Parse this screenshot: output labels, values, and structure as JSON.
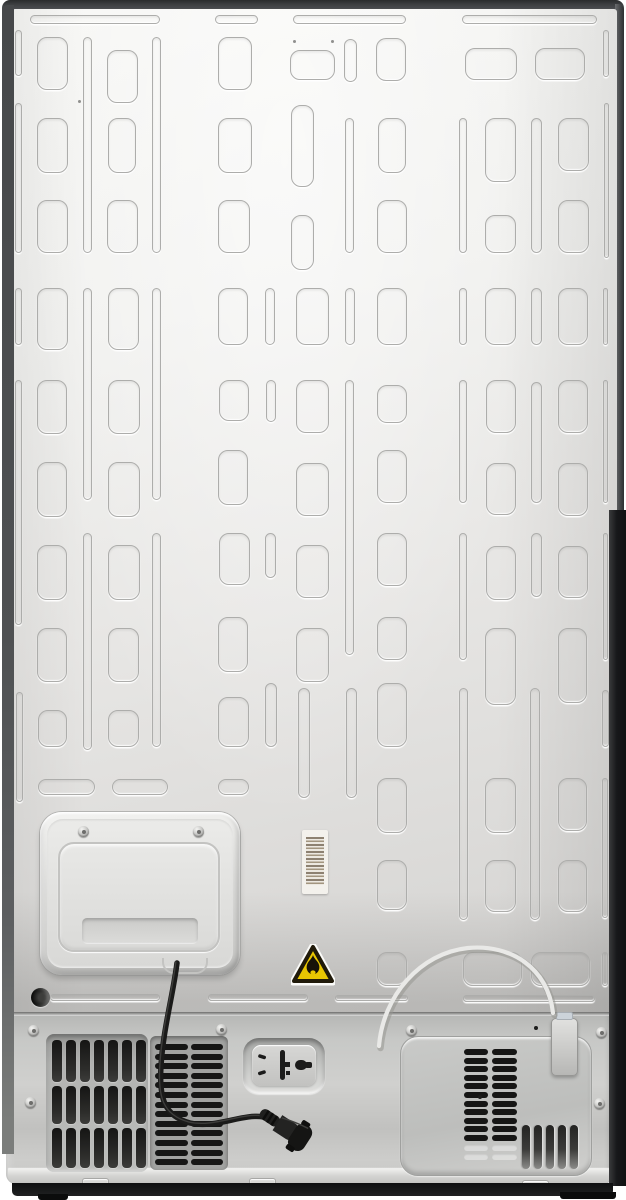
{
  "scene": {
    "label": "refrigerator-rear-view",
    "palette": {
      "panel_light": "#f7f7f5",
      "panel_dark": "#d3d2d0",
      "frame_dark": "#4f5153",
      "compartment_gray": "#c7c8c6",
      "slot_dark": "#1c1c1b",
      "warning_yellow": "#e8c602",
      "warning_border": "#201a0a",
      "barcode_bar": "#8d8171",
      "cord_black": "#1a1a19",
      "tube_white": "#e9e9e7"
    }
  },
  "pattern": {
    "vertical_rects": [
      [
        37,
        37,
        31,
        53
      ],
      [
        37,
        118,
        31,
        55
      ],
      [
        37,
        200,
        31,
        53
      ],
      [
        37,
        288,
        31,
        62
      ],
      [
        37,
        380,
        30,
        54
      ],
      [
        37,
        462,
        30,
        55
      ],
      [
        37,
        545,
        30,
        55
      ],
      [
        37,
        628,
        30,
        54
      ],
      [
        38,
        710,
        29,
        37
      ],
      [
        107,
        50,
        31,
        53
      ],
      [
        108,
        118,
        28,
        55
      ],
      [
        107,
        200,
        31,
        53
      ],
      [
        108,
        288,
        31,
        62
      ],
      [
        108,
        380,
        32,
        54
      ],
      [
        108,
        462,
        32,
        55
      ],
      [
        108,
        545,
        32,
        55
      ],
      [
        108,
        628,
        31,
        54
      ],
      [
        108,
        710,
        31,
        37
      ],
      [
        218,
        37,
        34,
        53
      ],
      [
        218,
        118,
        34,
        55
      ],
      [
        218,
        200,
        32,
        53
      ],
      [
        218,
        288,
        30,
        57
      ],
      [
        219,
        380,
        30,
        41
      ],
      [
        218,
        450,
        30,
        55
      ],
      [
        219,
        533,
        31,
        52
      ],
      [
        218,
        617,
        30,
        55
      ],
      [
        218,
        697,
        31,
        50
      ],
      [
        291,
        105,
        23,
        82
      ],
      [
        291,
        215,
        23,
        55
      ],
      [
        296,
        288,
        33,
        57
      ],
      [
        296,
        380,
        33,
        53
      ],
      [
        296,
        463,
        33,
        53
      ],
      [
        296,
        545,
        33,
        53
      ],
      [
        296,
        628,
        33,
        54
      ],
      [
        376,
        38,
        30,
        43
      ],
      [
        378,
        118,
        28,
        55
      ],
      [
        377,
        200,
        30,
        53
      ],
      [
        377,
        288,
        30,
        57
      ],
      [
        377,
        385,
        30,
        38
      ],
      [
        377,
        450,
        30,
        53
      ],
      [
        377,
        533,
        30,
        53
      ],
      [
        377,
        617,
        30,
        43
      ],
      [
        377,
        683,
        30,
        64
      ],
      [
        377,
        778,
        30,
        55
      ],
      [
        377,
        860,
        30,
        50
      ],
      [
        485,
        118,
        31,
        64
      ],
      [
        485,
        215,
        31,
        38
      ],
      [
        485,
        288,
        31,
        57
      ],
      [
        486,
        380,
        30,
        53
      ],
      [
        486,
        463,
        30,
        52
      ],
      [
        486,
        546,
        30,
        54
      ],
      [
        485,
        628,
        31,
        77
      ],
      [
        485,
        778,
        31,
        55
      ],
      [
        485,
        860,
        31,
        52
      ],
      [
        558,
        118,
        31,
        53
      ],
      [
        558,
        200,
        31,
        53
      ],
      [
        558,
        288,
        30,
        57
      ],
      [
        558,
        380,
        30,
        53
      ],
      [
        558,
        463,
        30,
        53
      ],
      [
        558,
        546,
        30,
        52
      ],
      [
        558,
        628,
        29,
        75
      ],
      [
        558,
        778,
        29,
        53
      ],
      [
        558,
        860,
        29,
        52
      ]
    ],
    "vertical_pills": [
      [
        15,
        30,
        7,
        46
      ],
      [
        15,
        103,
        7,
        150
      ],
      [
        15,
        288,
        7,
        57
      ],
      [
        15,
        380,
        7,
        245
      ],
      [
        16,
        692,
        7,
        110
      ],
      [
        83,
        37,
        9,
        216
      ],
      [
        83,
        288,
        9,
        212
      ],
      [
        83,
        533,
        9,
        217
      ],
      [
        152,
        37,
        9,
        216
      ],
      [
        152,
        288,
        9,
        212
      ],
      [
        152,
        533,
        9,
        214
      ],
      [
        265,
        288,
        10,
        57
      ],
      [
        266,
        380,
        10,
        42
      ],
      [
        265,
        533,
        11,
        45
      ],
      [
        265,
        683,
        12,
        64
      ],
      [
        298,
        688,
        12,
        110
      ],
      [
        344,
        39,
        13,
        43
      ],
      [
        345,
        118,
        9,
        135
      ],
      [
        345,
        288,
        10,
        57
      ],
      [
        345,
        380,
        9,
        275
      ],
      [
        346,
        688,
        11,
        110
      ],
      [
        459,
        118,
        8,
        135
      ],
      [
        459,
        288,
        8,
        57
      ],
      [
        459,
        380,
        8,
        123
      ],
      [
        459,
        533,
        8,
        127
      ],
      [
        459,
        688,
        9,
        232
      ],
      [
        531,
        118,
        11,
        135
      ],
      [
        531,
        288,
        11,
        57
      ],
      [
        531,
        382,
        11,
        121
      ],
      [
        531,
        533,
        11,
        64
      ],
      [
        530,
        688,
        10,
        232
      ],
      [
        603,
        30,
        6,
        47
      ],
      [
        604,
        103,
        5,
        155
      ],
      [
        603,
        288,
        5,
        57
      ],
      [
        603,
        380,
        5,
        123
      ],
      [
        603,
        533,
        5,
        127
      ],
      [
        602,
        690,
        7,
        57
      ],
      [
        602,
        778,
        6,
        140
      ],
      [
        602,
        952,
        6,
        34
      ]
    ],
    "horizontal_pills": [
      [
        30,
        15,
        130,
        9
      ],
      [
        215,
        15,
        43,
        9
      ],
      [
        293,
        15,
        113,
        9
      ],
      [
        462,
        15,
        135,
        9
      ],
      [
        50,
        994,
        110,
        7
      ],
      [
        208,
        994,
        100,
        7
      ],
      [
        335,
        995,
        73,
        6
      ],
      [
        463,
        995,
        132,
        7
      ]
    ],
    "wide_rects": [
      [
        290,
        50,
        45,
        30
      ],
      [
        465,
        48,
        52,
        32
      ],
      [
        535,
        48,
        50,
        32
      ],
      [
        38,
        779,
        57,
        16
      ],
      [
        112,
        779,
        56,
        16
      ],
      [
        218,
        779,
        31,
        16
      ],
      [
        377,
        952,
        30,
        34
      ],
      [
        463,
        952,
        59,
        34
      ],
      [
        531,
        952,
        59,
        34
      ]
    ],
    "spot_dots": [
      [
        78,
        100
      ],
      [
        293,
        40
      ],
      [
        331,
        40
      ]
    ]
  },
  "access_panel": {
    "screws": [
      [
        38,
        14
      ],
      [
        153,
        14
      ]
    ]
  },
  "compartment": {
    "screws": [
      [
        22,
        13
      ],
      [
        210,
        12
      ],
      [
        400,
        13
      ],
      [
        590,
        15
      ],
      [
        19,
        85
      ],
      [
        588,
        86
      ]
    ],
    "pin_dots": [
      [
        528,
        14
      ],
      [
        472,
        83
      ]
    ],
    "left_vent": {
      "x": 40,
      "y": 22,
      "w": 102,
      "h": 138,
      "rows": [
        {
          "y": 6,
          "h": 42
        },
        {
          "y": 52,
          "h": 38
        },
        {
          "y": 94,
          "h": 40
        }
      ],
      "cols": [
        6,
        20,
        34,
        48,
        62,
        76,
        90
      ],
      "slot_w": 9.5
    },
    "mid_vent": {
      "x": 144,
      "y": 24,
      "w": 78,
      "h": 134,
      "cols": [
        {
          "x": 5,
          "w": 33
        },
        {
          "x": 41,
          "w": 32
        }
      ],
      "slat_h": 6,
      "gap": 3.6,
      "count": 13,
      "start_y": 8
    },
    "right_panel": {
      "x": 394,
      "y": 24,
      "w": 192,
      "h": 140,
      "slat_cols": [
        {
          "x": 63,
          "w": 24
        },
        {
          "x": 91,
          "w": 25
        }
      ],
      "slat_h": 6,
      "gap": 2.6,
      "count": 11,
      "start_y": 12,
      "ghost_rows": [
        108,
        117
      ],
      "vslots": {
        "xs": [
          121,
          133,
          145,
          157,
          169
        ],
        "w": 7.5,
        "y": 88,
        "h": 44
      }
    },
    "tabs": [
      [
        76,
        166
      ],
      [
        243,
        166
      ],
      [
        516,
        168
      ]
    ]
  },
  "cord": {
    "path": "M177,963 C173,995 163,1030 161,1066 C159,1098 164,1116 190,1123 C215,1129 243,1113 264,1117"
  },
  "tube": {
    "path": "M379,1046 C383,996 420,953 468,948 C511,944 548,968 553,1013"
  }
}
